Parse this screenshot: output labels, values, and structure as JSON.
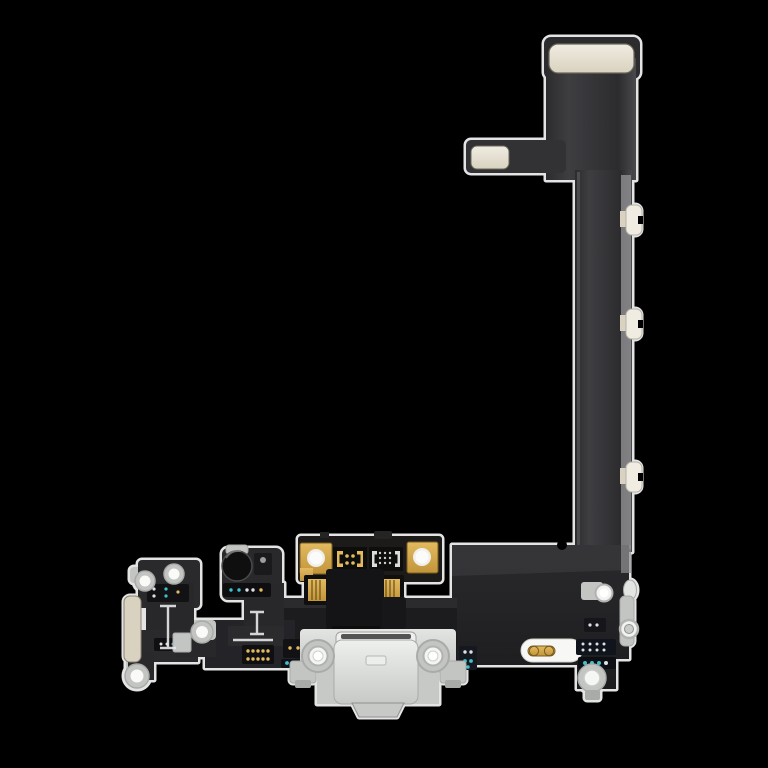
{
  "image": {
    "kind": "product-photo",
    "subject": "smartphone-charging-port-flex-cable-assembly",
    "background": "#000000"
  },
  "palette": {
    "bg": "#000000",
    "halo": "#f8f8f8",
    "flexLight": "#3e3e41",
    "flexDark": "#2c2c2f",
    "boardLight": "#2a2a2d",
    "boardDark": "#1c1c1f",
    "edgeStrip": "#909092",
    "cream": "#f0ece1",
    "creamDeep": "#d9d2c0",
    "creamBorder": "#6b675c",
    "gold": "#e3ba60",
    "goldDeep": "#c2953a",
    "goldDark": "#7a5c1e",
    "silverLight": "#e3e5e3",
    "silver": "#c2c5c2",
    "silverDark": "#a8aba8",
    "portFace": "#eef0ee",
    "portBody": "#dfe1df",
    "portShade": "#c6c9c6",
    "ringGray": "#b0b3b0",
    "chip": "#121214",
    "navy": "#10141c",
    "teal": "#3fc0cc",
    "dotWhite": "#dde0e4",
    "white": "#ffffff"
  },
  "components": {
    "board-connector-pad": "cream stiffener pad at top connector end",
    "flex-ribbon-arm": "short side arm with cream pad",
    "flex-ribbon-vertical": "long vertical flex ribbon with metal edge strip",
    "adhesive-tabs": "three cream pull tabs on ribbon right edge",
    "main-flex-board": "wide black flex board across the bottom",
    "antenna-flex": "small left flex with screw eyelets and beige bracket strip",
    "microphone": "round bottom microphone",
    "charging-port-module": "port PCB with gold screw pads, ICs and board-to-board connectors",
    "port-bracket": "silver shield bracket with two screw bosses",
    "lightning-port": "light gray charging receptacle",
    "battery-contact-pill": "white pill with gold contact capsule",
    "right-edge-hardware": "eyelet strip, screw tab and boss on right edge"
  }
}
